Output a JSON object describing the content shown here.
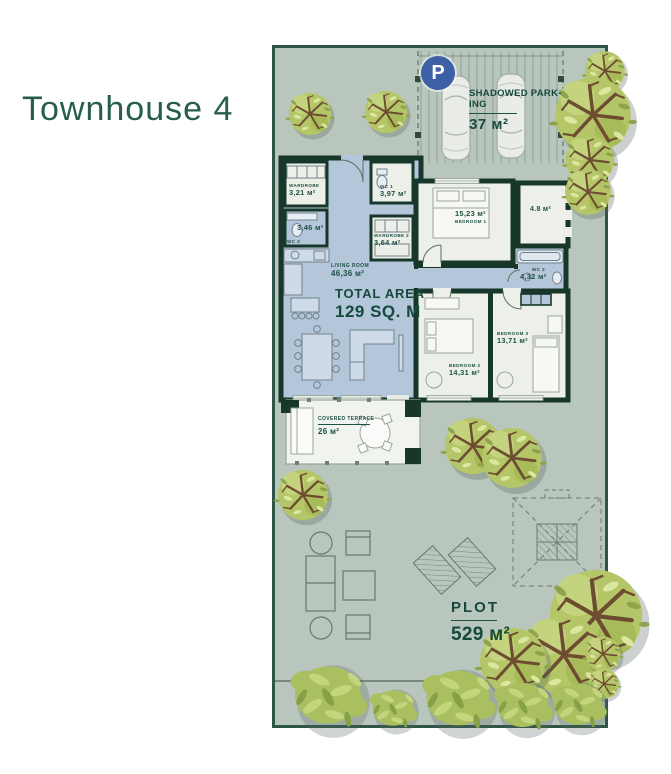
{
  "title": "Townhouse 4",
  "parking": {
    "badge": "P",
    "line1": "SHADOWED PARK-",
    "line2": "ING",
    "area": "37 м²"
  },
  "total_area": {
    "label": "TOTAL AREA",
    "value": "129 SQ. M"
  },
  "plot": {
    "label": "PLOT",
    "area": "529 м²"
  },
  "rooms": {
    "wardrobe": {
      "name": "WARDROBE",
      "area": "3,21 м²"
    },
    "wc3": {
      "name": "WC 3",
      "area": "3,46 м²"
    },
    "wc1": {
      "name": "WC 1",
      "area": "3,97 м²"
    },
    "wardrobe2": {
      "name": "WARDROBE 2",
      "area": "3,64 м²"
    },
    "living": {
      "name": "LIVING ROOM",
      "area": "46,36 м²"
    },
    "bedroom1": {
      "name": "BEDROOM 1",
      "area": "15,23 м²"
    },
    "balcony": {
      "area": "4.8 м²"
    },
    "wc2": {
      "name": "WC 2",
      "area": "4,32 м²"
    },
    "bedroom2": {
      "name": "BEDROOM 2",
      "area": "14,31 м²"
    },
    "bedroom3": {
      "name": "BEDROOM 3",
      "area": "13,71 м²"
    },
    "terrace": {
      "name": "COVERED TERRACE",
      "area": "26 м²"
    }
  },
  "colors": {
    "accent_teal": "#1d5145",
    "wall": "#16372a",
    "blue_floor": "#b4c6da",
    "light_floor": "#edefe9",
    "plot_bg": "#b9c6bd",
    "tree_green": "#b5c669",
    "parking_badge_blue": "#3d5fa5"
  }
}
